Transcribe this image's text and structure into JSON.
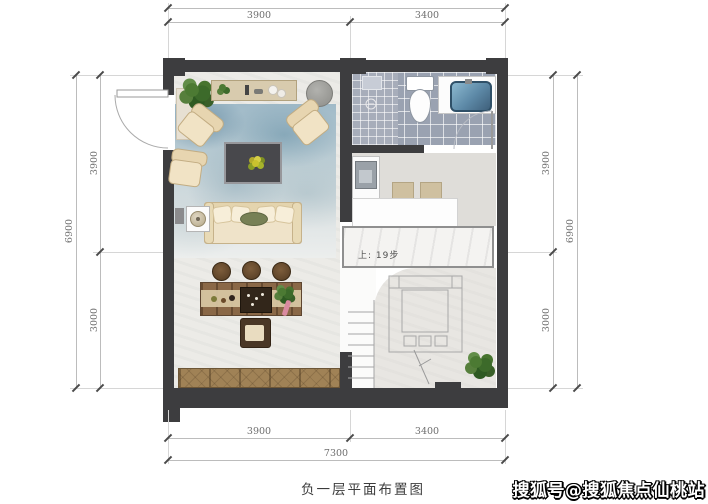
{
  "caption": {
    "text": "负一层平面布置图"
  },
  "watermark": {
    "text": "搜狐号@搜狐焦点仙桃站"
  },
  "labels": {
    "stairs_note": "上: 19步"
  },
  "dims": {
    "top_outer": "7300",
    "top_inner_left": "3900",
    "top_inner_right": "3400",
    "bottom_inner_left": "3900",
    "bottom_inner_right": "3400",
    "bottom_outer": "7300",
    "left_outer": "6900",
    "left_inner_top": "3900",
    "left_inner_bottom": "3000",
    "right_outer": "6900",
    "right_inner_top": "3900",
    "right_inner_bottom": "3000"
  },
  "colors": {
    "wall": "#3d3d3f",
    "rug_blue": "#a0bac8",
    "bath_tile": "#9aa2b1",
    "sink_blue": "#5c88a6",
    "wood": "#a08256",
    "pillow_green": "#778055",
    "marble": "#f4f3f1"
  }
}
